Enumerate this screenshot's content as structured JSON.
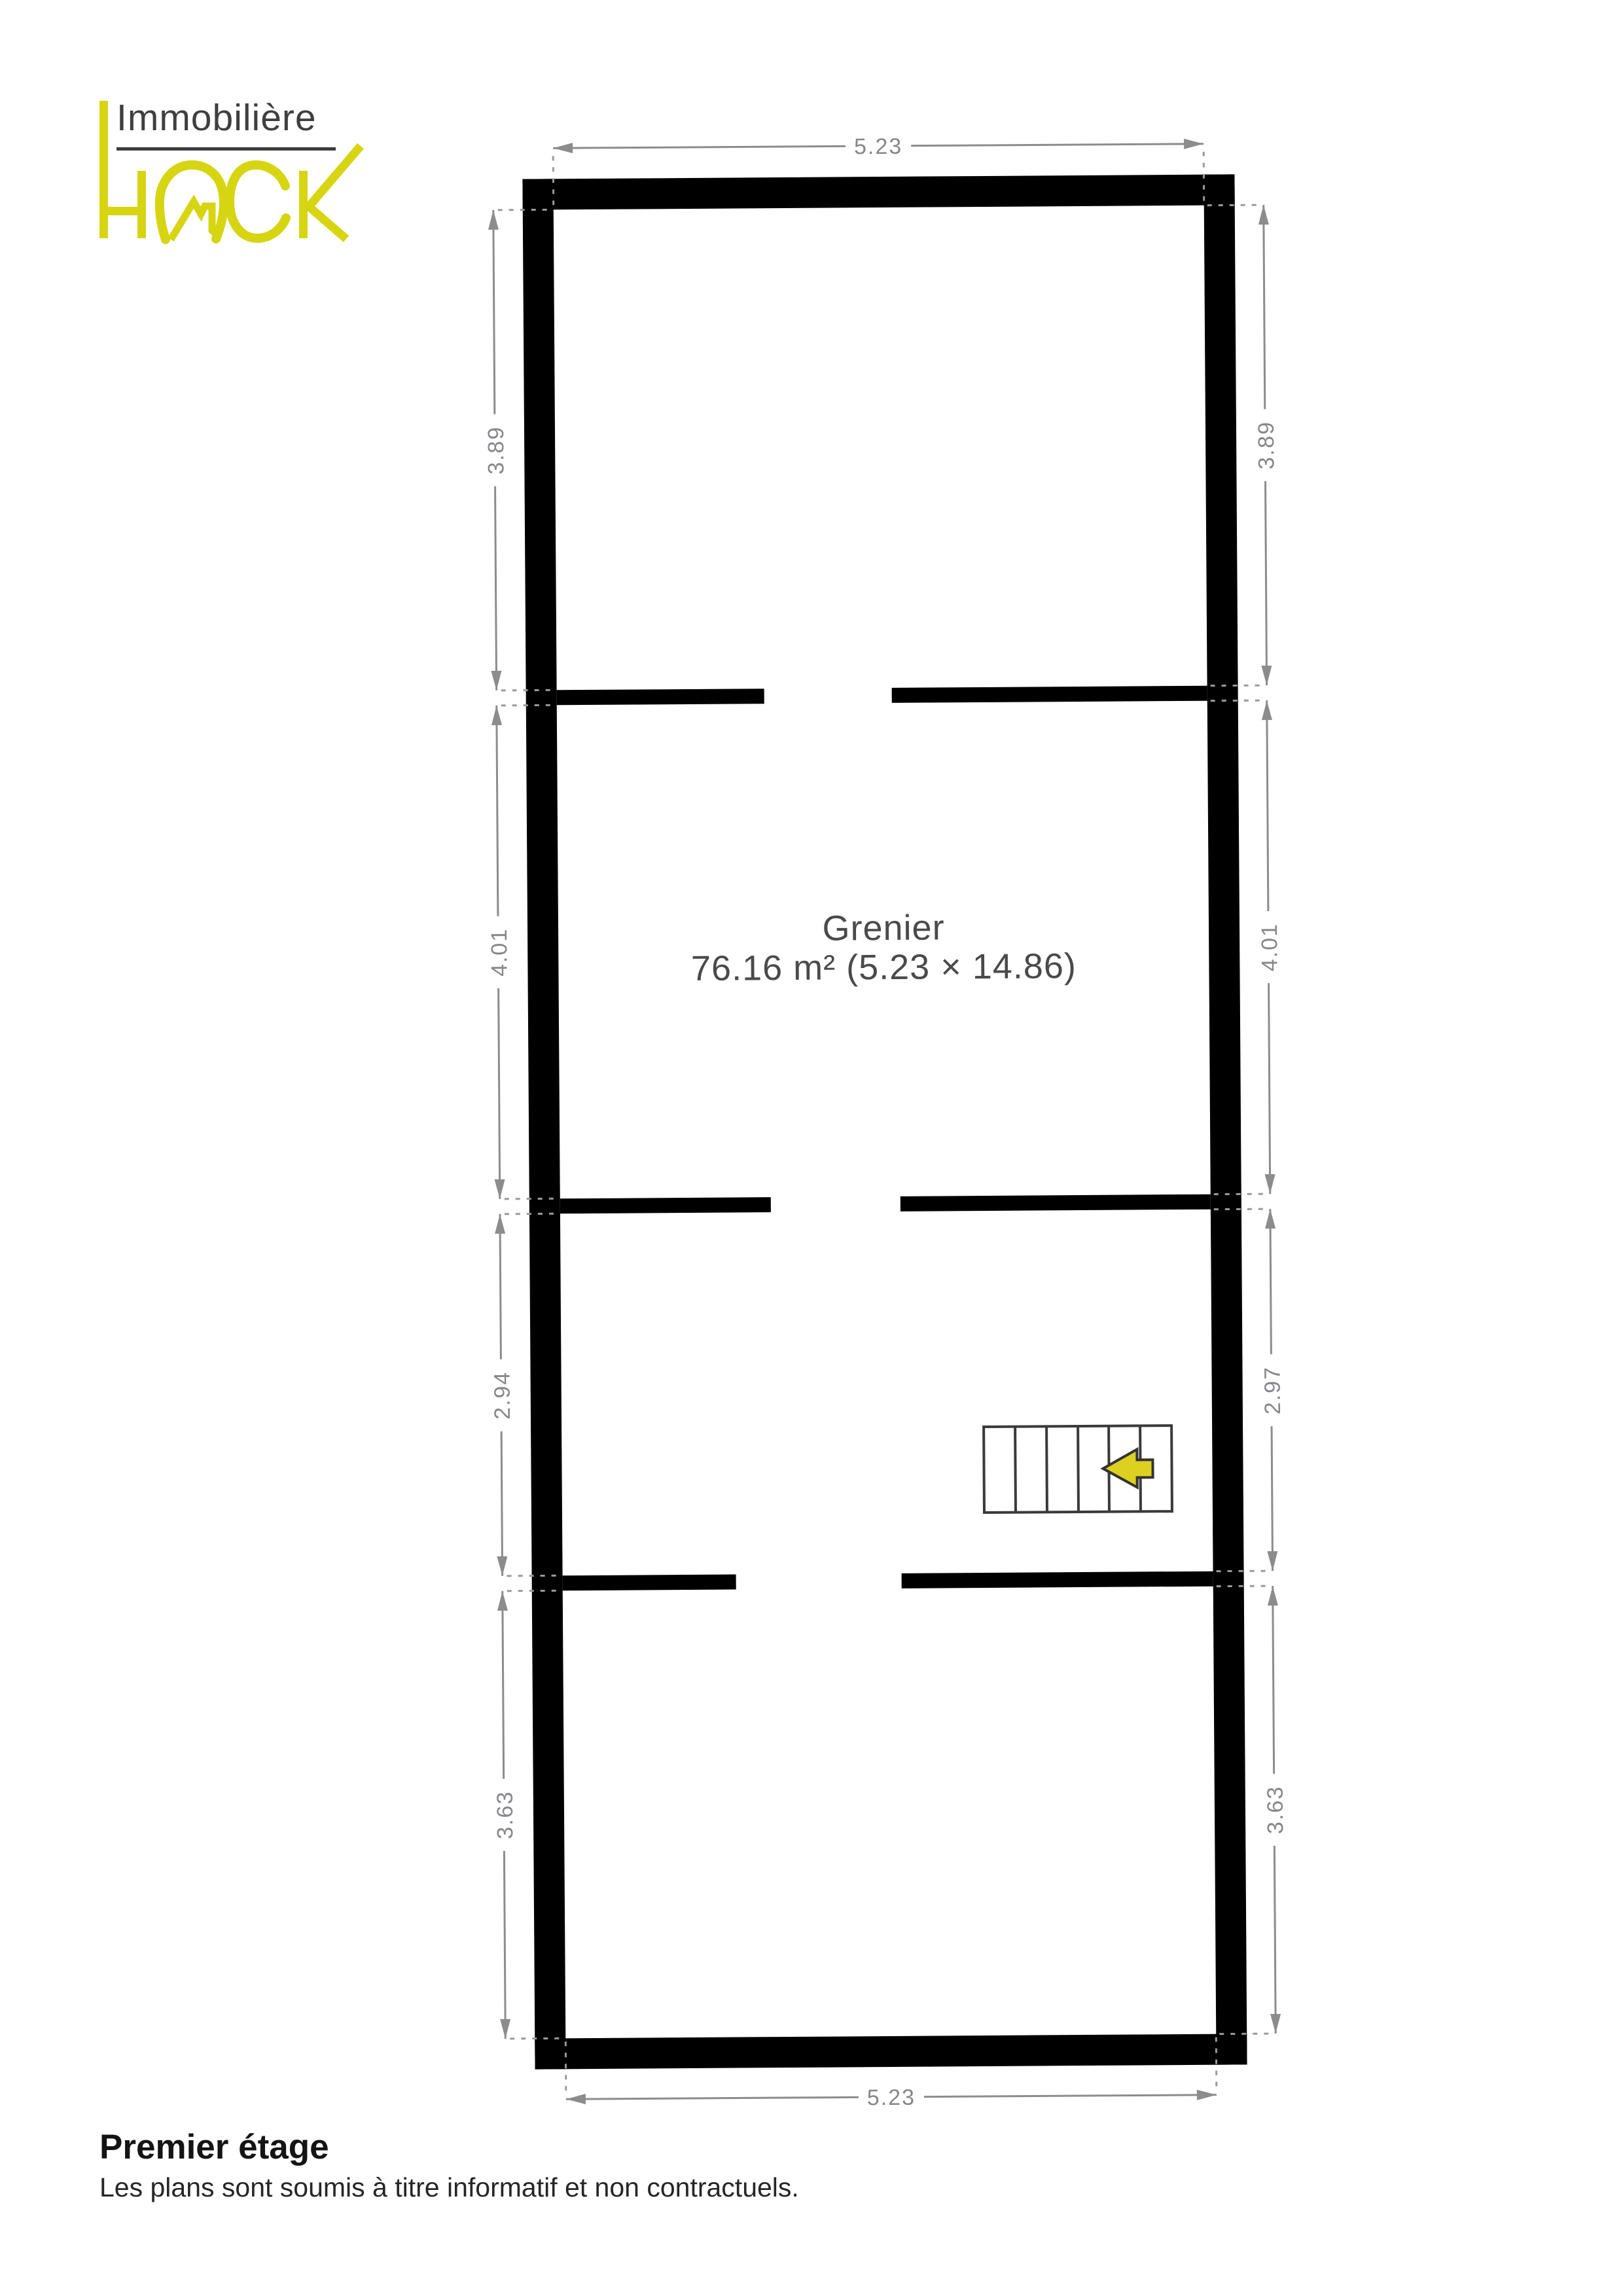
{
  "logo": {
    "brand_top": "Immobilière",
    "brand_bottom": "HACK"
  },
  "room": {
    "name": "Grenier",
    "area_label": "76.16 m² (5.23 × 14.86)"
  },
  "dimensions": {
    "top": "5.23",
    "bottom": "5.23",
    "left": [
      "3.89",
      "4.01",
      "2.94",
      "3.63"
    ],
    "right": [
      "3.89",
      "4.01",
      "2.97",
      "3.63"
    ]
  },
  "footer": {
    "title": "Premier étage",
    "disclaimer": "Les plans sont soumis à titre informatif et non contractuels."
  },
  "colors": {
    "accent": "#d7d512",
    "arrow": "#ddd020",
    "wall": "#000000",
    "dimension": "#8c8c8c"
  }
}
